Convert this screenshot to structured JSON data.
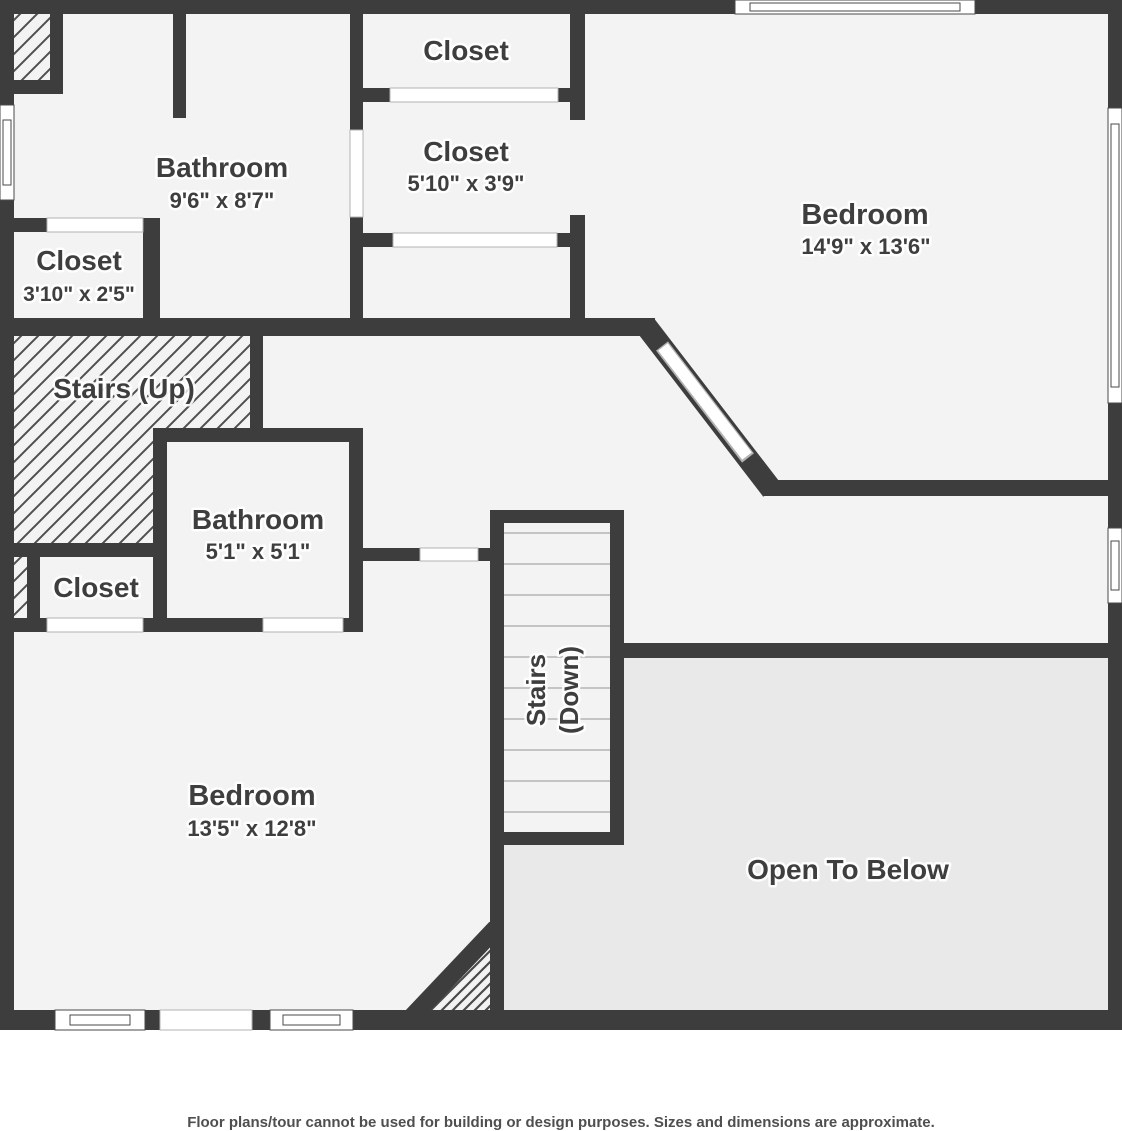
{
  "plan": {
    "title": "Upper floor plan",
    "rooms": {
      "bathroom_main": {
        "name": "Bathroom",
        "dims": "9'6\" x 8'7\""
      },
      "closet_hall": {
        "name": "Closet",
        "dims": "3'10\" x 2'5\""
      },
      "closet_top": {
        "name": "Closet"
      },
      "closet_walkin": {
        "name": "Closet",
        "dims": "5'10\" x 3'9\""
      },
      "bedroom_right": {
        "name": "Bedroom",
        "dims": "14'9\" x 13'6\""
      },
      "stairs_up": {
        "name": "Stairs (Up)"
      },
      "bathroom_ensuite": {
        "name": "Bathroom",
        "dims": "5'1\" x 5'1\""
      },
      "closet_small": {
        "name": "Closet"
      },
      "stairs_down": {
        "line1": "Stairs",
        "line2": "(Down)"
      },
      "bedroom_left": {
        "name": "Bedroom",
        "dims": "13'5\" x 12'8\""
      },
      "open_to_below": {
        "name": "Open To Below"
      }
    },
    "colors": {
      "wall": "#3d3d3d",
      "floor": "#f3f3f4",
      "open_to_below_floor": "#e9e9e9",
      "label_text": "#3e3e3e",
      "background": "#ffffff"
    }
  },
  "footer": {
    "disclaimer": "Floor plans/tour cannot be used for building or design purposes. Sizes and dimensions are approximate."
  }
}
